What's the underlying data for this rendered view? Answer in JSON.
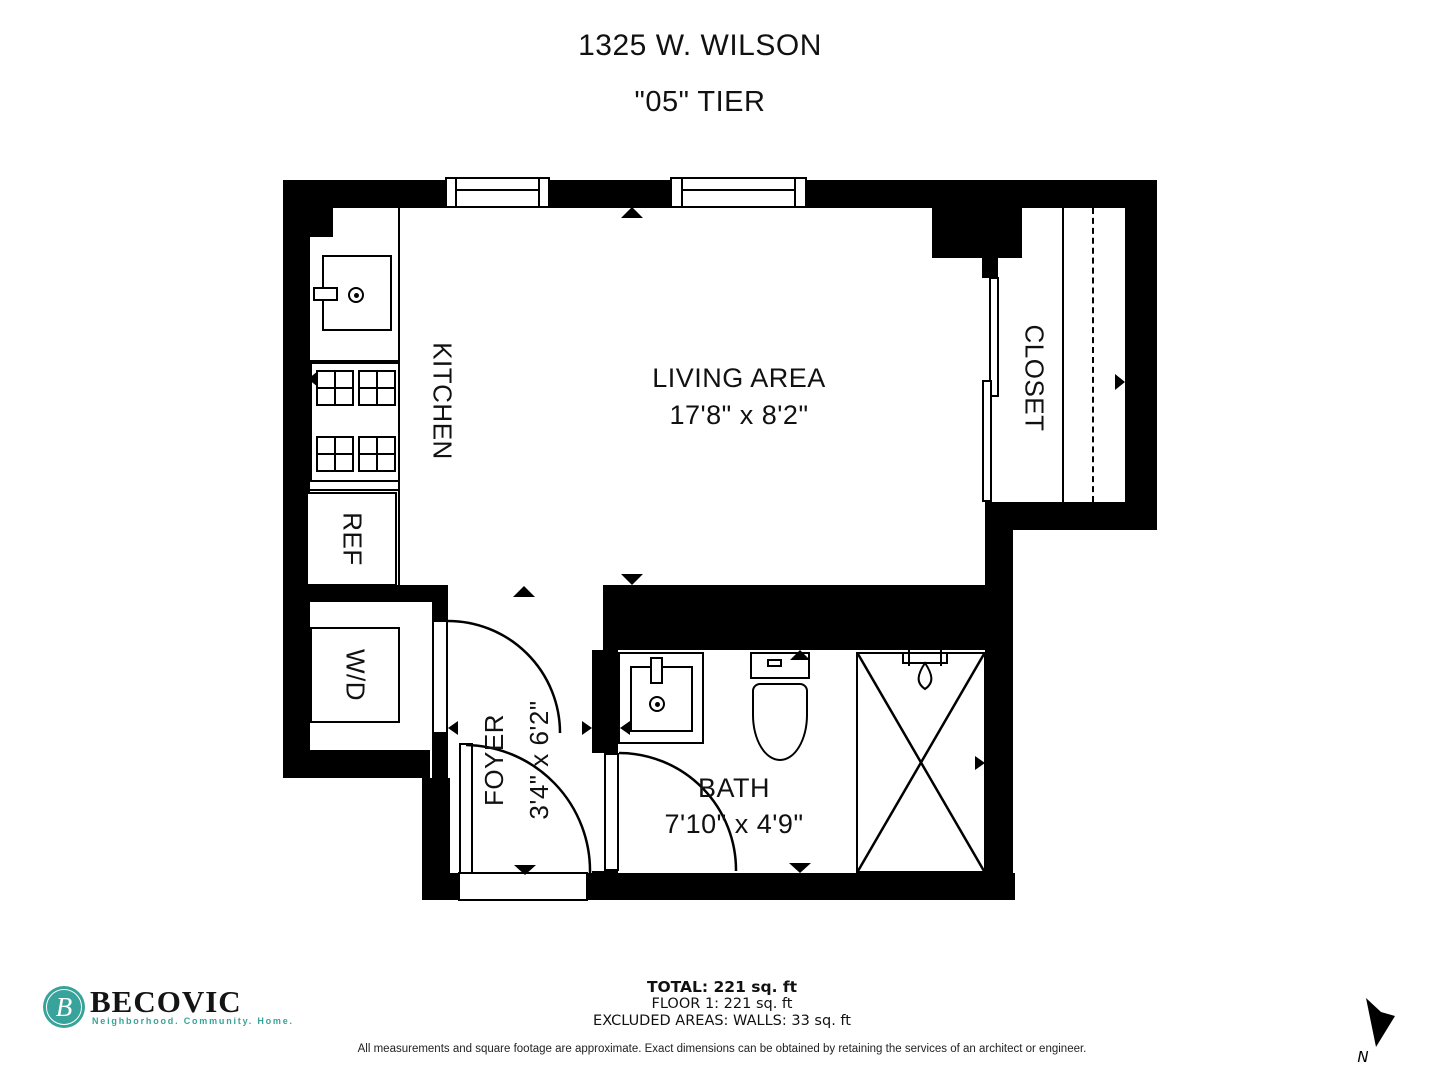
{
  "title": {
    "address": "1325 W. WILSON",
    "tier": "\"05\" TIER"
  },
  "rooms": {
    "living": {
      "name": "LIVING AREA",
      "dims": "17'8\" x 8'2\""
    },
    "kitchen": {
      "name": "KITCHEN"
    },
    "closet": {
      "name": "CLOSET"
    },
    "ref": {
      "name": "REF"
    },
    "wd": {
      "name": "W/D"
    },
    "foyer": {
      "name": "FOYER",
      "dims": "3'4\" x 6'2\""
    },
    "bath": {
      "name": "BATH",
      "dims": "7'10\" x 4'9\""
    }
  },
  "footer": {
    "brand": {
      "name": "BECOVIC",
      "tagline": "Neighborhood. Community. Home.",
      "logo_letter": "B",
      "teal": "#38a39a"
    },
    "stats": {
      "total": "TOTAL: 221 sq. ft",
      "floor": "FLOOR 1: 221 sq. ft",
      "excluded": "EXCLUDED AREAS: WALLS: 33 sq. ft"
    },
    "disclaimer": "All measurements and square footage are approximate. Exact dimensions can be obtained by retaining the services of an architect or engineer.",
    "compass": {
      "label": "N"
    }
  },
  "colors": {
    "wall": "#000000",
    "background": "#ffffff",
    "accent_teal": "#38a39a"
  }
}
